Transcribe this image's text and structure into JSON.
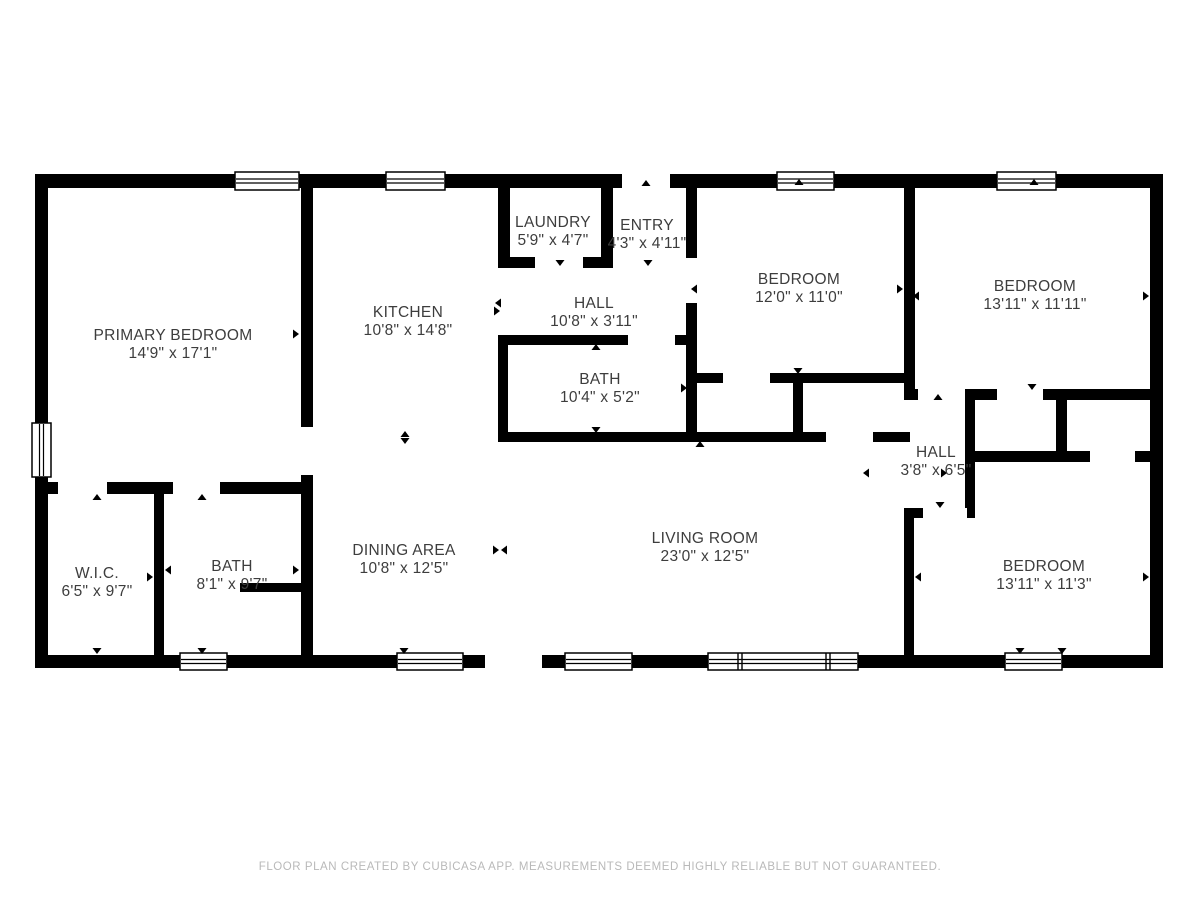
{
  "page": {
    "footer": "FLOOR PLAN CREATED BY CUBICASA APP. MEASUREMENTS DEEMED HIGHLY RELIABLE BUT NOT GUARANTEED."
  },
  "colors": {
    "wall": "#000000",
    "floor": "#ffffff",
    "label": "#3d3d3d",
    "footer_text": "#b9b9b9"
  },
  "rooms": [
    {
      "id": "primary-bedroom",
      "name": "PRIMARY BEDROOM",
      "dims": "14'9\" x 17'1\"",
      "cx": 173,
      "cy": 345
    },
    {
      "id": "kitchen",
      "name": "KITCHEN",
      "dims": "10'8\" x 14'8\"",
      "cx": 408,
      "cy": 322
    },
    {
      "id": "laundry",
      "name": "LAUNDRY",
      "dims": "5'9\" x 4'7\"",
      "cx": 553,
      "cy": 232
    },
    {
      "id": "entry",
      "name": "ENTRY",
      "dims": "4'3\" x 4'11\"",
      "cx": 647,
      "cy": 235
    },
    {
      "id": "hall",
      "name": "HALL",
      "dims": "10'8\" x 3'11\"",
      "cx": 594,
      "cy": 313
    },
    {
      "id": "bath",
      "name": "BATH",
      "dims": "10'4\" x 5'2\"",
      "cx": 600,
      "cy": 389
    },
    {
      "id": "bedroom-1",
      "name": "BEDROOM",
      "dims": "12'0\" x 11'0\"",
      "cx": 799,
      "cy": 289
    },
    {
      "id": "bedroom-2",
      "name": "BEDROOM",
      "dims": "13'11\" x 11'11\"",
      "cx": 1035,
      "cy": 296
    },
    {
      "id": "hall-2",
      "name": "HALL",
      "dims": "3'8\" x 6'5\"",
      "cx": 936,
      "cy": 462
    },
    {
      "id": "wic",
      "name": "W.I.C.",
      "dims": "6'5\" x 9'7\"",
      "cx": 97,
      "cy": 583
    },
    {
      "id": "bath-2",
      "name": "BATH",
      "dims": "8'1\" x 9'7\"",
      "cx": 232,
      "cy": 576
    },
    {
      "id": "dining-area",
      "name": "DINING AREA",
      "dims": "10'8\" x 12'5\"",
      "cx": 404,
      "cy": 560
    },
    {
      "id": "living-room",
      "name": "LIVING ROOM",
      "dims": "23'0\" x 12'5\"",
      "cx": 705,
      "cy": 548
    },
    {
      "id": "bedroom-3",
      "name": "BEDROOM",
      "dims": "13'11\" x 11'3\"",
      "cx": 1044,
      "cy": 576
    }
  ],
  "geometry": {
    "canvas": {
      "w": 1200,
      "h": 900
    },
    "walls": [
      [
        35,
        174,
        1128,
        14
      ],
      [
        35,
        655,
        1128,
        13
      ],
      [
        35,
        174,
        13,
        494
      ],
      [
        1150,
        174,
        13,
        494
      ],
      [
        301,
        188,
        12,
        467
      ],
      [
        35,
        482,
        266,
        12
      ],
      [
        154,
        494,
        10,
        161
      ],
      [
        240,
        583,
        61,
        9
      ],
      [
        498,
        188,
        12,
        79
      ],
      [
        498,
        257,
        115,
        11
      ],
      [
        601,
        188,
        12,
        80
      ],
      [
        686,
        188,
        11,
        254
      ],
      [
        498,
        335,
        188,
        10
      ],
      [
        498,
        345,
        10,
        97
      ],
      [
        498,
        432,
        412,
        10
      ],
      [
        686,
        373,
        224,
        10
      ],
      [
        793,
        383,
        10,
        49
      ],
      [
        904,
        188,
        11,
        212
      ],
      [
        904,
        389,
        259,
        11
      ],
      [
        965,
        400,
        10,
        118
      ],
      [
        1056,
        400,
        11,
        51
      ],
      [
        975,
        451,
        188,
        11
      ],
      [
        904,
        508,
        71,
        10
      ],
      [
        904,
        518,
        10,
        137
      ]
    ],
    "openings": [
      [
        301,
        427,
        12,
        48
      ],
      [
        58,
        482,
        49,
        12
      ],
      [
        173,
        482,
        47,
        12
      ],
      [
        535,
        257,
        48,
        11
      ],
      [
        686,
        258,
        11,
        45
      ],
      [
        628,
        335,
        47,
        10
      ],
      [
        723,
        373,
        47,
        10
      ],
      [
        826,
        432,
        47,
        10
      ],
      [
        918,
        389,
        47,
        11
      ],
      [
        997,
        389,
        46,
        11
      ],
      [
        1090,
        451,
        45,
        11
      ],
      [
        923,
        508,
        44,
        10
      ],
      [
        622,
        174,
        48,
        14
      ],
      [
        485,
        655,
        57,
        13
      ]
    ],
    "windows": [
      {
        "x": 235,
        "y": 172,
        "w": 64,
        "h": 18,
        "dir": "h",
        "mullions": []
      },
      {
        "x": 386,
        "y": 172,
        "w": 59,
        "h": 18,
        "dir": "h",
        "mullions": []
      },
      {
        "x": 777,
        "y": 172,
        "w": 57,
        "h": 18,
        "dir": "h",
        "mullions": []
      },
      {
        "x": 997,
        "y": 172,
        "w": 59,
        "h": 18,
        "dir": "h",
        "mullions": []
      },
      {
        "x": 32,
        "y": 423,
        "w": 19,
        "h": 54,
        "dir": "v",
        "mullions": []
      },
      {
        "x": 180,
        "y": 653,
        "w": 47,
        "h": 17,
        "dir": "h",
        "mullions": []
      },
      {
        "x": 397,
        "y": 653,
        "w": 66,
        "h": 17,
        "dir": "h",
        "mullions": []
      },
      {
        "x": 565,
        "y": 653,
        "w": 67,
        "h": 17,
        "dir": "h",
        "mullions": []
      },
      {
        "x": 708,
        "y": 653,
        "w": 150,
        "h": 17,
        "dir": "h",
        "mullions": [
          740,
          828
        ]
      },
      {
        "x": 1005,
        "y": 653,
        "w": 57,
        "h": 17,
        "dir": "h",
        "mullions": []
      }
    ],
    "markers": [
      [
        172,
        183,
        "up"
      ],
      [
        556,
        183,
        "up"
      ],
      [
        646,
        183,
        "up"
      ],
      [
        799,
        182,
        "up"
      ],
      [
        1034,
        182,
        "up"
      ],
      [
        560,
        263,
        "down"
      ],
      [
        648,
        263,
        "down"
      ],
      [
        498,
        303,
        "left"
      ],
      [
        497,
        311,
        "right"
      ],
      [
        594,
        338,
        "down"
      ],
      [
        596,
        347,
        "up"
      ],
      [
        45,
        334,
        "left"
      ],
      [
        296,
        334,
        "right"
      ],
      [
        504,
        388,
        "left"
      ],
      [
        684,
        388,
        "right"
      ],
      [
        596,
        430,
        "down"
      ],
      [
        405,
        434,
        "up"
      ],
      [
        405,
        441,
        "down"
      ],
      [
        700,
        444,
        "up"
      ],
      [
        798,
        371,
        "down"
      ],
      [
        1032,
        387,
        "down"
      ],
      [
        938,
        397,
        "up"
      ],
      [
        940,
        505,
        "down"
      ],
      [
        694,
        289,
        "left"
      ],
      [
        900,
        289,
        "right"
      ],
      [
        916,
        296,
        "left"
      ],
      [
        1146,
        296,
        "right"
      ],
      [
        866,
        473,
        "left"
      ],
      [
        944,
        473,
        "right"
      ],
      [
        45,
        577,
        "left"
      ],
      [
        150,
        577,
        "right"
      ],
      [
        168,
        570,
        "left"
      ],
      [
        296,
        570,
        "right"
      ],
      [
        918,
        577,
        "left"
      ],
      [
        1146,
        577,
        "right"
      ],
      [
        97,
        497,
        "up"
      ],
      [
        202,
        497,
        "up"
      ],
      [
        97,
        651,
        "down"
      ],
      [
        202,
        651,
        "down"
      ],
      [
        404,
        651,
        "down"
      ],
      [
        1020,
        651,
        "down"
      ],
      [
        1062,
        651,
        "down"
      ],
      [
        496,
        550,
        "right"
      ],
      [
        504,
        550,
        "left"
      ]
    ]
  }
}
